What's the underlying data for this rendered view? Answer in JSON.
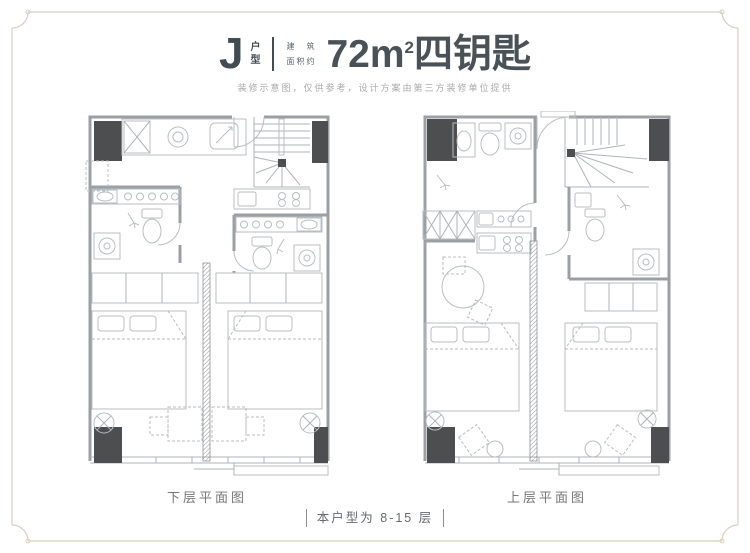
{
  "header": {
    "unit_letter": "J",
    "unit_type_vertical": [
      "户",
      "型"
    ],
    "area_prefix_line1": "建筑",
    "area_prefix_line2": "面积约",
    "area_value": "72m",
    "area_exponent": "2",
    "area_suffix": "四钥匙",
    "disclaimer": "装修示意图，仅供参考，设计方案由第三方装修单位提供"
  },
  "plans": {
    "lower": {
      "label": "下层平面图"
    },
    "upper": {
      "label": "上层平面图"
    }
  },
  "footer": {
    "floor_note": "本户型为 8-15 层"
  },
  "colors": {
    "title_text": "#414c53",
    "disclaimer_text": "#aaaaaa",
    "label_text": "#767676",
    "wall_line": "#9aa0a4",
    "furniture_line": "#b9bec2",
    "column_fill": "#4d4e50",
    "frame_border": "#d8d1c2",
    "background": "#ffffff"
  }
}
